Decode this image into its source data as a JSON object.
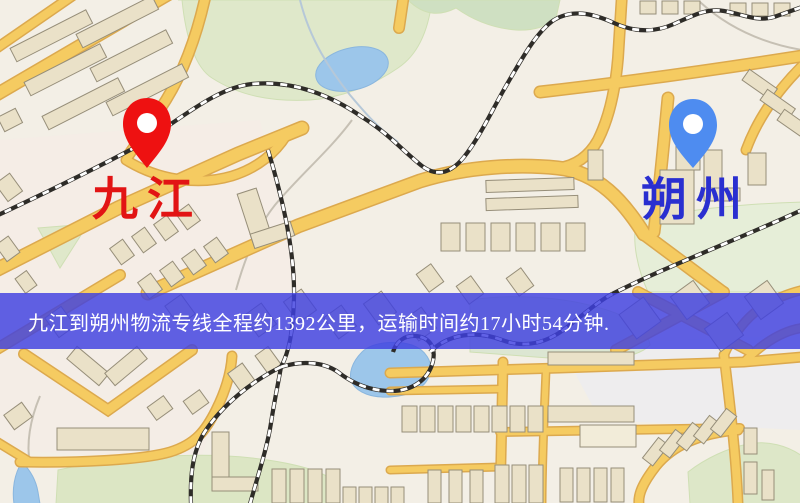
{
  "map": {
    "origin_marker": {
      "label": "九江",
      "label_color": "#e21414",
      "pin_color": "#ee1111"
    },
    "destination_marker": {
      "label": "朔州",
      "label_color": "#2a2fd0",
      "pin_color": "#4e8cf0"
    },
    "banner": {
      "text": "九江到朔州物流专线全程约1392公里，运输时间约17小时54分钟.",
      "text_color": "#ffffff",
      "background_color": "rgba(62,64,224,0.82)",
      "distance_km": "1392",
      "duration": "17小时54分钟"
    },
    "colors": {
      "map_background": "#f3efe6",
      "road": "#f5cb61",
      "road_casing": "#dca94e",
      "park_green": "#dfe8ca",
      "water_blue": "#9cc6ea",
      "building": "#eae1c8",
      "railway": "#2e2c28"
    }
  }
}
